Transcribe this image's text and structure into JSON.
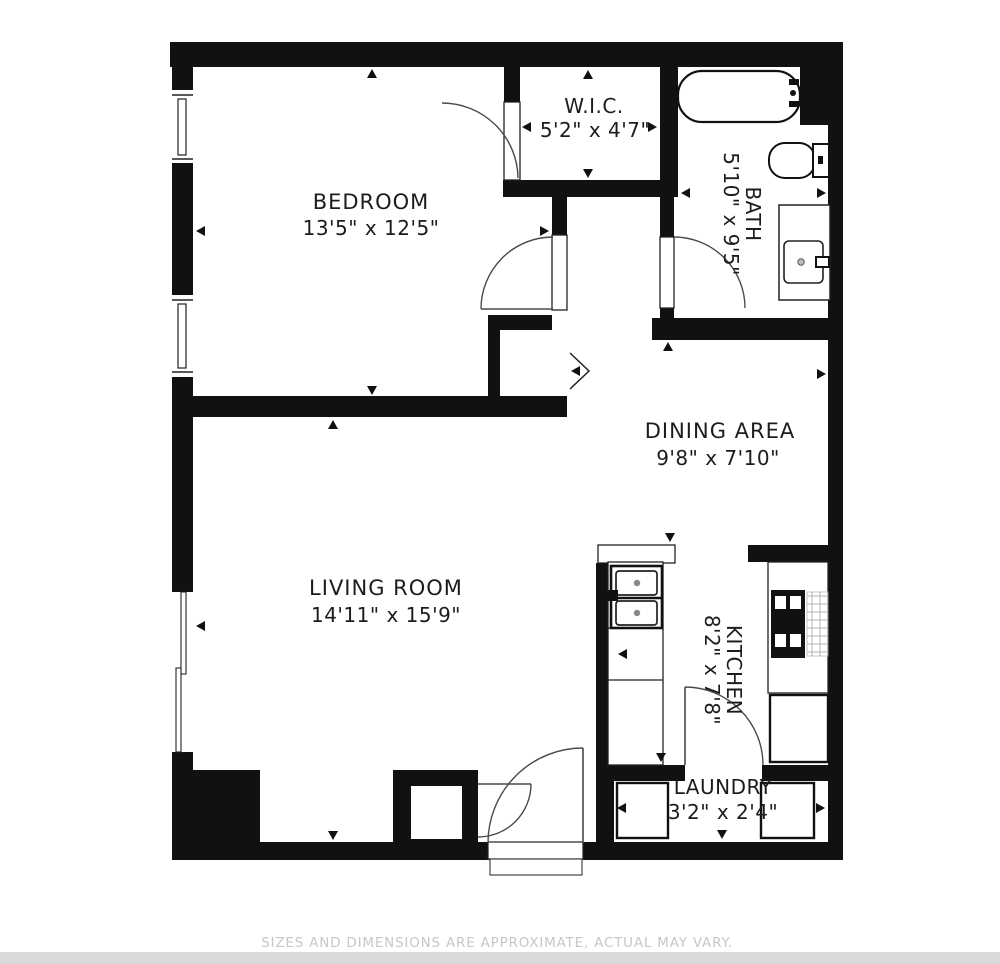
{
  "floor_plan": {
    "rooms": {
      "bedroom": {
        "name": "BEDROOM",
        "dims": "13'5\" x 12'5\""
      },
      "wic": {
        "name": "W.I.C.",
        "dims": "5'2\" x 4'7\""
      },
      "bath": {
        "name": "BATH",
        "dims": "5'10\" x 9'5\""
      },
      "dining": {
        "name": "DINING AREA",
        "dims": "9'8\" x 7'10\""
      },
      "living": {
        "name": "LIVING ROOM",
        "dims": "14'11\" x 15'9\""
      },
      "kitchen": {
        "name": "KITCHEN",
        "dims": "8'2\" x 7'8\""
      },
      "laundry": {
        "name": "LAUNDRY",
        "dims": "3'2\" x 2'4\""
      }
    },
    "fixtures": {
      "bathtub": "bathtub-icon",
      "toilet": "toilet-icon",
      "bath_vanity": "bathroom-sink-icon",
      "kitchen_sink": "kitchen-sink-icon",
      "stove": "stove-icon",
      "fridge": "fridge-icon",
      "washer": "washer-icon",
      "dryer": "dryer-icon"
    },
    "footer": "SIZES AND DIMENSIONS ARE APPROXIMATE, ACTUAL MAY VARY.",
    "colors": {
      "wall": "#111111",
      "background": "#ffffff",
      "footer_text": "#c7c7c7",
      "bottom_strip": "#d9d9d9"
    }
  }
}
